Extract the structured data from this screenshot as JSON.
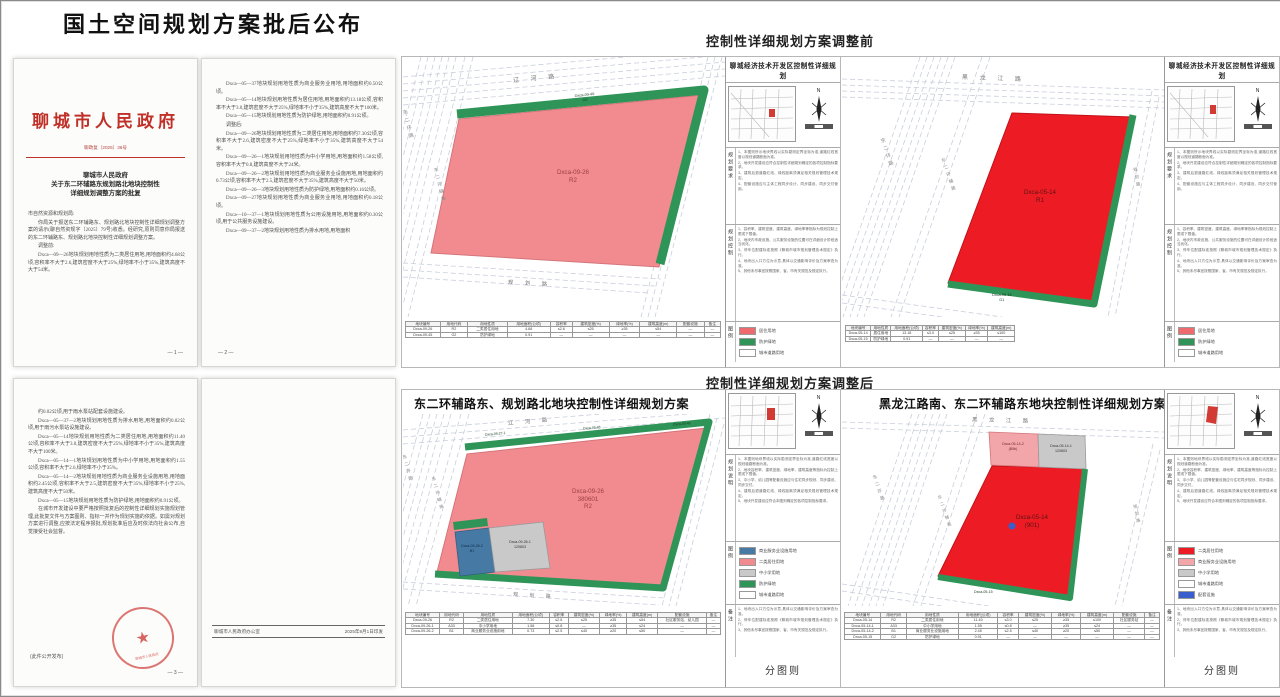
{
  "page": {
    "title": "国土空间规划方案批后公布",
    "section_before": "控制性详细规划方案调整前",
    "section_after": "控制性详细规划方案调整后",
    "caption": "分图则"
  },
  "colors": {
    "pink": "#f28b90",
    "red": "#ed1c24",
    "green": "#2f9458",
    "blue": "#4679a4",
    "gray": "#c9c9c9",
    "seal_red": "#c92a26",
    "header_red": "#c03028"
  },
  "docs": {
    "d1": {
      "agency": "聊城市人民政府",
      "doc_no": "聊政复〔2025〕36号",
      "title_lines": [
        "聊城市人民政府",
        "关于东二环辅路东规划路北地块控制性",
        "详细规划调整方案的批复"
      ],
      "salutation": "市自然资源和规划局:",
      "paragraphs": [
        "你局关于报送东二环辅路东、规划路北地块控制性详细规划调整方案的请示(聊自然资规字〔2025〕79号)收悉。经研究,原则同意你局报送的东二环辅路东、规划路北地块控制性详细规划调整方案。",
        "调整前:",
        "Dxca—09—26地块规划用地性质为二类居住用地,用地面积约4.68公顷,容积率不大于2.6,建筑密度不大于25%,绿地率不小于35%,建筑高度不大于54米。"
      ],
      "page_no": "— 1 —"
    },
    "d2": {
      "paragraphs": [
        "Dxca—05—37地块规划用地性质为商业服务业用地,用地面积约0.50公顷。",
        "Dxca—05—14地块规划用地性质为居住用地,用地面积约13.18公顷,容积率不大于3.0,建筑密度不大于25%,绿地率不小于35%,建筑高度不大于100米。",
        "Dxca—05—15地块规划用地性质为防护绿地,用地面积约0.91公顷。",
        "调整后:",
        "Dxca—09—26地块规划用地性质为二类居住用地,用地面积约7.30公顷,容积率不大于2.6,建筑密度不大于25%,绿地率不小于35%,建筑高度不大于54米。",
        "Dxca—09—26—1地块规划用地性质为中小学用地,用地面积约1.58公顷,容积率不大于0.8,建筑高度不大于24米。",
        "Dxca—09—26—2地块规划用地性质为商业服务业设施用地,用地面积约0.73公顷,容积率不大于2.5,建筑密度不大于35%,建筑高度不大于50米。",
        "Dxca—09—26—3地块规划用地性质为防护绿地,用地面积约0.16公顷。",
        "Dxca—09—27地块规划用地性质为商业服务业用地,用地面积约0.18公顷。",
        "Dxca—10—37—1地块规划用地性质为公用设施用地,用地面积约0.30公顷,用于公共服务设施建设。",
        "Dxca—09—37—2地块规划用地性质为排水用地,用地面积"
      ],
      "page_no": "— 2 —"
    },
    "d3": {
      "paragraphs": [
        "约0.02公顷,用于雨水泵站配套设施建设。",
        "Dxca—05—37—2地块规划用地性质为排水用地,用地面积约0.02公顷,用于雨污水泵站设施建设。",
        "Dxca—05—14地块规划用地性质为二类居住用地,用地面积约11.40公顷,容积率不大于3.0,建筑密度不大于25%,绿地率不小于35%,建筑高度不大于100米。",
        "Dxca—05—14—1地块规划用地性质为中小学用地,用地面积约1.55公顷,容积率不大于2.6,绿地率不小于35%。",
        "Dxca—05—14—2地块规划用地性质为商业服务业设施用地,用地面积约2.45公顷,容积率不大于2.5,建筑密度不大于35%,绿地率不小于25%,建筑高度不大于50米。",
        "Dxca—05—15地块规划用地性质为防护绿地,用地面积约0.91公顷。",
        "在城市开发建设中要严格按照批复后的控制性详细规划实施规划管理,此批复文件与方案图则、指标一并作为规划实施的依据。如需对规划方案进行调整,应按法定程序报批,规划批准后应及时依法向社会公布,自觉接受社会监督。"
      ],
      "open_note": "(此件公开发布)",
      "seal_text": "聊城市人民政府",
      "page_no": "— 3 —"
    },
    "d4": {
      "footer_left": "聊城市人民政府办公室",
      "footer_right": "2025年9月1日印发"
    }
  },
  "sidebar": {
    "subtitle": "聊城经济技术开发区控制性详细规划",
    "sec_req": "规划要求",
    "sec_ctrl": "规划控制",
    "sec_legend": "图例",
    "sec_desc": "规划说明",
    "sec_note": "备注",
    "north": "N"
  },
  "notes": {
    "req": [
      "1、本图则所示地块界线以实际勘测定界坐标为准,道路红线宽度以规划道路断面为准。",
      "2、地块开发建设应符合控制性详细规划确定的各项控制指标要求。",
      "3、建筑后退道路红线、绿线距离须满足相关规划管理技术规定。",
      "4、配套设施应与主体工程同步设计、同步建设、同步交付使用。"
    ],
    "ctrl": [
      "1、容积率、建筑密度、建筑高度、绿地率等指标为规划控制上限或下限值。",
      "2、地块内市政设施、公共服务设施的位置可在详细设计阶段适当优化。",
      "3、停车位配建标准按照《聊城市城市规划管理技术规定》执行。",
      "4、地块出入口方位为示意,具体以交通影响评价及方案审查为准。",
      "5、其他未尽事宜按照国家、省、市有关规范及规定执行。"
    ],
    "desc": [
      "1、本图则地块界线以实际勘测定界坐标为准,道路红线宽度以规划道路断面为准。",
      "2、地块容积率、建筑密度、绿地率、建筑高度等指标为控制上限或下限值。",
      "3、中小学、幼儿园等配套设施应与住宅同步规划、同步建设、同步交付。",
      "4、建筑后退道路红线、绿线距离须满足相关规划管理技术规定。",
      "5、地块开发建设应符合本图则确定的各项控制指标要求。"
    ],
    "remark": [
      "1、地块出入口方位为示意,具体以交通影响评价及方案审查为准。",
      "2、停车位配建标准按照《聊城市城市规划管理技术规定》执行。",
      "3、其他未尽事宜按照国家、省、市有关规范及规定执行。"
    ]
  },
  "legends": {
    "ab": [
      {
        "color": "#ed6a6e",
        "label": "居住用地"
      },
      {
        "color": "#2f9458",
        "label": "防护绿地"
      },
      {
        "color": "#ffffff",
        "label": "城市道路用地"
      }
    ],
    "c": [
      {
        "color": "#4679a4",
        "label": "商业服务业设施用地"
      },
      {
        "color": "#f28b90",
        "label": "二类居住用地"
      },
      {
        "color": "#c9c9c9",
        "label": "中小学用地"
      },
      {
        "color": "#2f9458",
        "label": "防护绿地"
      },
      {
        "color": "#ffffff",
        "label": "城市道路用地"
      }
    ],
    "d": [
      {
        "color": "#ed1c24",
        "label": "二类居住用地"
      },
      {
        "color": "#f2a6aa",
        "label": "商业服务业设施用地"
      },
      {
        "color": "#c9c9c9",
        "label": "中小学用地"
      },
      {
        "color": "#ffffff",
        "label": "城市道路用地"
      },
      {
        "color": "#3a5fcd",
        "label": "配套设施"
      }
    ]
  },
  "maps": {
    "a": {
      "roads": {
        "top": "辽 河 路",
        "left": "东二环路",
        "left2": "东二环辅路",
        "bottom": "规 划 路"
      },
      "parcel": [
        "Dxca-09-26",
        "R2"
      ],
      "green": [
        "Dxca-09-45",
        "G2"
      ],
      "table": {
        "headers": [
          "地块编号",
          "用地代码",
          "用地性质",
          "用地面积(公顷)",
          "容积率",
          "建筑密度(%)",
          "绿地率(%)",
          "建筑高度(m)",
          "配套设施",
          "备注"
        ],
        "rows": [
          [
            "Dxca-09-26",
            "R2",
            "二类居住用地",
            "4.68",
            "≤2.6",
            "≤25",
            "≥35",
            "≤54",
            "—",
            "—"
          ],
          [
            "Dxca-09-45",
            "G2",
            "防护绿地",
            "0.91",
            "—",
            "—",
            "—",
            "—",
            "—",
            "—"
          ]
        ]
      }
    },
    "b": {
      "roads": {
        "top": "黑 龙 江 路",
        "left": "东二环路",
        "left2": "东二环辅路",
        "right": "规划路"
      },
      "parcel": [
        "Dxca-05-14",
        "R1"
      ],
      "green": [
        "Dxca-05-15",
        "G1"
      ],
      "table": {
        "headers": [
          "地块编号",
          "用地性质",
          "用地面积(公顷)",
          "容积率",
          "建筑密度(%)",
          "绿地率(%)",
          "建筑高度(m)"
        ],
        "rows": [
          [
            "Dxca-05-14",
            "居住用地",
            "13.18",
            "≤3.0",
            "≤25",
            "≥35",
            "≤100"
          ],
          [
            "Dxca-05-15",
            "防护绿地",
            "0.91",
            "—",
            "—",
            "—",
            "—"
          ]
        ]
      }
    },
    "c": {
      "title": "东二环辅路东、规划路北地块控制性详细规划方案",
      "roads": {
        "top": "辽 河 路",
        "left": "东二环路",
        "left2": "东二环辅路",
        "bottom": "规 划 路"
      },
      "parcel": [
        "Dxca-09-26",
        "380601",
        "R2"
      ],
      "school": [
        "Dxca-09-26-1",
        "120803"
      ],
      "biz": [
        "Dxca-09-26-2",
        "B1"
      ],
      "g1": "Dxca-09-27-1",
      "g2": "Dxca-09-45",
      "g3": "Dxca-09-46",
      "table": {
        "headers": [
          "地块编号",
          "用地代码",
          "用地性质",
          "用地面积(公顷)",
          "容积率",
          "建筑密度(%)",
          "绿地率(%)",
          "建筑高度(m)",
          "配套设施",
          "备注"
        ],
        "rows": [
          [
            "Dxca-09-26",
            "R2",
            "二类居住用地",
            "7.30",
            "≤2.6",
            "≤25",
            "≥35",
            "≤54",
            "社区服务站、幼儿园",
            "—"
          ],
          [
            "Dxca-09-26-1",
            "A33",
            "中小学用地",
            "1.58",
            "≤0.8",
            "—",
            "≥35",
            "≤24",
            "—",
            "—"
          ],
          [
            "Dxca-09-26-2",
            "B1",
            "商业服务业设施用地",
            "0.73",
            "≤2.5",
            "≤40",
            "≥20",
            "≤50",
            "—",
            "—"
          ]
        ]
      }
    },
    "d": {
      "title": "黑龙江路南、东二环辅路东地块控制性详细规划方案",
      "roads": {
        "top": "黑 龙 江 路",
        "left": "东二环路",
        "left2": "东二环辅路",
        "right": "规划路"
      },
      "parcel": [
        "Dxca-05-14",
        "(901)"
      ],
      "sub_pink": [
        "Dxca-05-14-2",
        "(B5b)"
      ],
      "sub_gray": [
        "Dxca-05-14-1",
        "120803"
      ],
      "green": "Dxca-05-15",
      "table": {
        "headers": [
          "地块编号",
          "用地代码",
          "用地性质",
          "用地面积(公顷)",
          "容积率",
          "建筑密度(%)",
          "绿地率(%)",
          "建筑高度(m)",
          "配套设施",
          "备注"
        ],
        "rows": [
          [
            "Dxca-05-14",
            "R2",
            "二类居住用地",
            "11.40",
            "≤3.0",
            "≤25",
            "≥35",
            "≤100",
            "社区服务站",
            "—"
          ],
          [
            "Dxca-05-14-1",
            "A33",
            "中小学用地",
            "1.55",
            "≤0.8",
            "—",
            "≥35",
            "≤24",
            "—",
            "—"
          ],
          [
            "Dxca-05-14-2",
            "B1",
            "商业服务业设施用地",
            "2.45",
            "≤2.5",
            "≤40",
            "≥20",
            "≤50",
            "—",
            "—"
          ],
          [
            "Dxca-05-15",
            "G2",
            "防护绿地",
            "0.91",
            "—",
            "—",
            "—",
            "—",
            "—",
            "—"
          ]
        ]
      }
    }
  }
}
